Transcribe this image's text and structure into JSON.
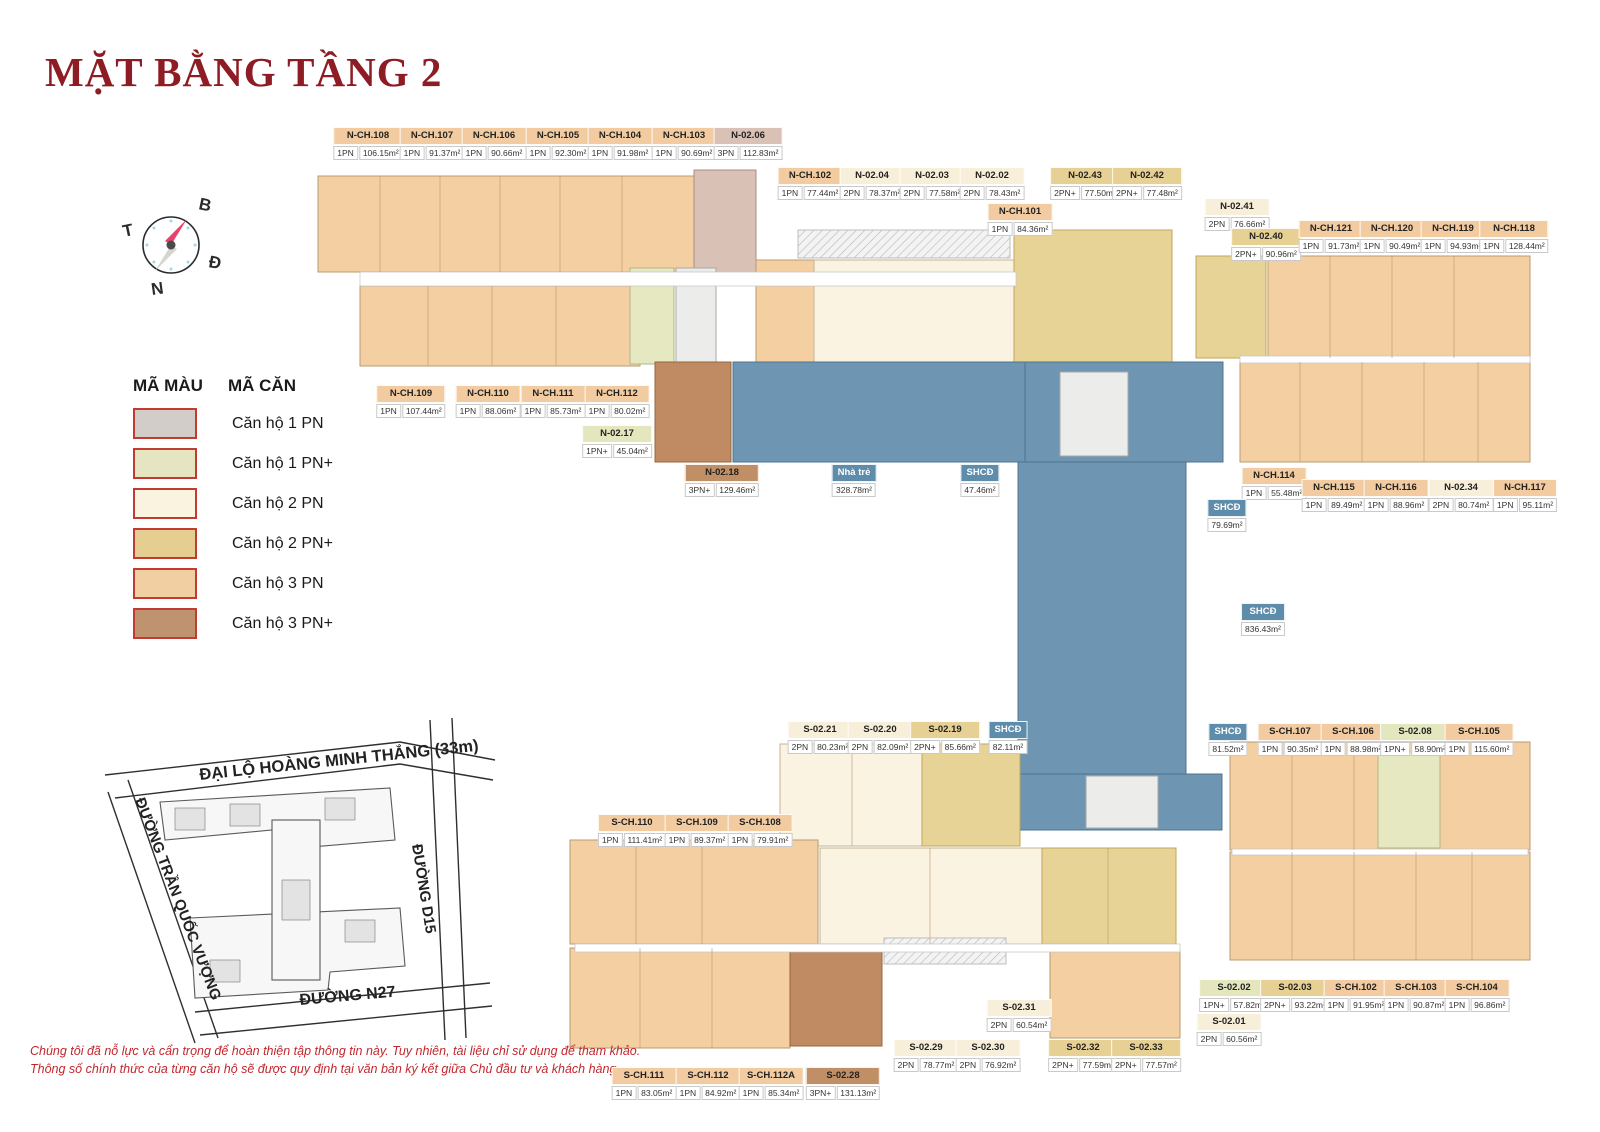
{
  "title": "MẶT BẰNG TẦNG 2",
  "compass": {
    "north": "B",
    "east": "Đ",
    "south": "N",
    "west": "T"
  },
  "legend": {
    "col1_header": "MÃ MÀU",
    "col2_header": "MÃ CĂN",
    "items": [
      {
        "type": "1PN",
        "label": "Căn hộ 1 PN",
        "color": "#d3cdc9"
      },
      {
        "type": "1PN+",
        "label": "Căn hộ 1 PN+",
        "color": "#e5e5c2"
      },
      {
        "type": "2PN",
        "label": "Căn hộ 2 PN",
        "color": "#faf3e0"
      },
      {
        "type": "2PN+",
        "label": "Căn hộ 2 PN+",
        "color": "#e5cf90"
      },
      {
        "type": "3PN",
        "label": "Căn hộ 3 PN",
        "color": "#f2cfa3"
      },
      {
        "type": "3PN+",
        "label": "Căn hộ 3 PN+",
        "color": "#bf9270"
      }
    ],
    "swatch_border_color": "#c13b33"
  },
  "site_map": {
    "streets": [
      "ĐẠI LỘ HOÀNG MINH THẮNG (33m)",
      "ĐƯỜNG TRẦN QUỐC VƯỢNG",
      "ĐƯỜNG D15",
      "ĐƯỜNG N27"
    ]
  },
  "disclaimer": {
    "line1": "Chúng tôi đã nỗ lực và cẩn trọng để hoàn thiện tập thông tin này. Tuy nhiên, tài liệu chỉ sử dụng để tham khảo.",
    "line2": "Thông số chính thức của từng căn hộ sẽ được quy định tại văn bản ký kết giữa Chủ đầu tư và khách hàng."
  },
  "shcd_color": "#6e95b1",
  "units": [
    {
      "code": "N-CH.108",
      "beds": "1PN",
      "area": "106.15m²",
      "x": 368,
      "y": 127,
      "hdr": "orange"
    },
    {
      "code": "N-CH.107",
      "beds": "1PN",
      "area": "91.37m²",
      "x": 432,
      "y": 127,
      "hdr": "orange"
    },
    {
      "code": "N-CH.106",
      "beds": "1PN",
      "area": "90.66m²",
      "x": 494,
      "y": 127,
      "hdr": "orange"
    },
    {
      "code": "N-CH.105",
      "beds": "1PN",
      "area": "92.30m²",
      "x": 558,
      "y": 127,
      "hdr": "orange"
    },
    {
      "code": "N-CH.104",
      "beds": "1PN",
      "area": "91.98m²",
      "x": 620,
      "y": 127,
      "hdr": "orange"
    },
    {
      "code": "N-CH.103",
      "beds": "1PN",
      "area": "90.69m²",
      "x": 684,
      "y": 127,
      "hdr": "orange"
    },
    {
      "code": "N-02.06",
      "beds": "3PN",
      "area": "112.83m²",
      "x": 748,
      "y": 127,
      "hdr": "pink"
    },
    {
      "code": "N-CH.102",
      "beds": "1PN",
      "area": "77.44m²",
      "x": 810,
      "y": 167,
      "hdr": "orange"
    },
    {
      "code": "N-02.04",
      "beds": "2PN",
      "area": "78.37m²",
      "x": 872,
      "y": 167,
      "hdr": "cream"
    },
    {
      "code": "N-02.03",
      "beds": "2PN",
      "area": "77.58m²",
      "x": 932,
      "y": 167,
      "hdr": "cream"
    },
    {
      "code": "N-02.02",
      "beds": "2PN",
      "area": "78.43m²",
      "x": 992,
      "y": 167,
      "hdr": "cream"
    },
    {
      "code": "N-02.43",
      "beds": "2PN+",
      "area": "77.50m²",
      "x": 1085,
      "y": 167,
      "hdr": "tan"
    },
    {
      "code": "N-02.42",
      "beds": "2PN+",
      "area": "77.48m²",
      "x": 1147,
      "y": 167,
      "hdr": "tan"
    },
    {
      "code": "N-CH.101",
      "beds": "1PN",
      "area": "84.36m²",
      "x": 1020,
      "y": 203,
      "hdr": "orange"
    },
    {
      "code": "N-02.41",
      "beds": "2PN",
      "area": "76.66m²",
      "x": 1237,
      "y": 198,
      "hdr": "cream"
    },
    {
      "code": "N-02.40",
      "beds": "2PN+",
      "area": "90.96m²",
      "x": 1266,
      "y": 228,
      "hdr": "tan"
    },
    {
      "code": "N-CH.121",
      "beds": "1PN",
      "area": "91.73m²",
      "x": 1331,
      "y": 220,
      "hdr": "orange"
    },
    {
      "code": "N-CH.120",
      "beds": "1PN",
      "area": "90.49m²",
      "x": 1392,
      "y": 220,
      "hdr": "orange"
    },
    {
      "code": "N-CH.119",
      "beds": "1PN",
      "area": "94.93m²",
      "x": 1453,
      "y": 220,
      "hdr": "orange"
    },
    {
      "code": "N-CH.118",
      "beds": "1PN",
      "area": "128.44m²",
      "x": 1514,
      "y": 220,
      "hdr": "orange"
    },
    {
      "code": "N-CH.109",
      "beds": "1PN",
      "area": "107.44m²",
      "x": 411,
      "y": 385,
      "hdr": "orange"
    },
    {
      "code": "N-CH.110",
      "beds": "1PN",
      "area": "88.06m²",
      "x": 488,
      "y": 385,
      "hdr": "orange"
    },
    {
      "code": "N-CH.111",
      "beds": "1PN",
      "area": "85.73m²",
      "x": 553,
      "y": 385,
      "hdr": "orange"
    },
    {
      "code": "N-CH.112",
      "beds": "1PN",
      "area": "80.02m²",
      "x": 617,
      "y": 385,
      "hdr": "orange"
    },
    {
      "code": "N-02.17",
      "beds": "1PN+",
      "area": "45.04m²",
      "x": 617,
      "y": 425,
      "hdr": "green"
    },
    {
      "code": "N-02.18",
      "beds": "3PN+",
      "area": "129.46m²",
      "x": 722,
      "y": 464,
      "hdr": "brown"
    },
    {
      "code": "Nhà trẻ",
      "beds": null,
      "area": "328.78m²",
      "x": 854,
      "y": 464,
      "hdr": "blue"
    },
    {
      "code": "SHCĐ",
      "beds": null,
      "area": "47.46m²",
      "x": 980,
      "y": 464,
      "hdr": "blue"
    },
    {
      "code": "N-CH.114",
      "beds": "1PN",
      "area": "55.48m²",
      "x": 1274,
      "y": 467,
      "hdr": "orange"
    },
    {
      "code": "N-CH.115",
      "beds": "1PN",
      "area": "89.49m²",
      "x": 1334,
      "y": 479,
      "hdr": "orange"
    },
    {
      "code": "N-CH.116",
      "beds": "1PN",
      "area": "88.96m²",
      "x": 1396,
      "y": 479,
      "hdr": "orange"
    },
    {
      "code": "N-02.34",
      "beds": "2PN",
      "area": "80.74m²",
      "x": 1461,
      "y": 479,
      "hdr": "cream"
    },
    {
      "code": "N-CH.117",
      "beds": "1PN",
      "area": "95.11m²",
      "x": 1525,
      "y": 479,
      "hdr": "orange"
    },
    {
      "code": "SHCĐ",
      "beds": null,
      "area": "79.69m²",
      "x": 1227,
      "y": 499,
      "hdr": "blue"
    },
    {
      "code": "SHCĐ",
      "beds": null,
      "area": "836.43m²",
      "x": 1263,
      "y": 603,
      "hdr": "blue"
    },
    {
      "code": "S-02.21",
      "beds": "2PN",
      "area": "80.23m²",
      "x": 820,
      "y": 721,
      "hdr": "cream"
    },
    {
      "code": "S-02.20",
      "beds": "2PN",
      "area": "82.09m²",
      "x": 880,
      "y": 721,
      "hdr": "cream"
    },
    {
      "code": "S-02.19",
      "beds": "2PN+",
      "area": "85.66m²",
      "x": 945,
      "y": 721,
      "hdr": "tan"
    },
    {
      "code": "SHCĐ",
      "beds": null,
      "area": "82.11m²",
      "x": 1008,
      "y": 721,
      "hdr": "blue"
    },
    {
      "code": "SHCĐ",
      "beds": null,
      "area": "81.52m²",
      "x": 1228,
      "y": 723,
      "hdr": "blue"
    },
    {
      "code": "S-CH.107",
      "beds": "1PN",
      "area": "90.35m²",
      "x": 1290,
      "y": 723,
      "hdr": "orange"
    },
    {
      "code": "S-CH.106",
      "beds": "1PN",
      "area": "88.98m²",
      "x": 1353,
      "y": 723,
      "hdr": "orange"
    },
    {
      "code": "S-02.08",
      "beds": "1PN+",
      "area": "58.90m²",
      "x": 1415,
      "y": 723,
      "hdr": "green"
    },
    {
      "code": "S-CH.105",
      "beds": "1PN",
      "area": "115.60m²",
      "x": 1479,
      "y": 723,
      "hdr": "orange"
    },
    {
      "code": "S-CH.110",
      "beds": "1PN",
      "area": "111.41m²",
      "x": 632,
      "y": 814,
      "hdr": "orange"
    },
    {
      "code": "S-CH.109",
      "beds": "1PN",
      "area": "89.37m²",
      "x": 697,
      "y": 814,
      "hdr": "orange"
    },
    {
      "code": "S-CH.108",
      "beds": "1PN",
      "area": "79.91m²",
      "x": 760,
      "y": 814,
      "hdr": "orange"
    },
    {
      "code": "S-02.02",
      "beds": "1PN+",
      "area": "57.82m²",
      "x": 1234,
      "y": 979,
      "hdr": "green"
    },
    {
      "code": "S-02.03",
      "beds": "2PN+",
      "area": "93.22m²",
      "x": 1295,
      "y": 979,
      "hdr": "tan"
    },
    {
      "code": "S-CH.102",
      "beds": "1PN",
      "area": "91.95m²",
      "x": 1356,
      "y": 979,
      "hdr": "orange"
    },
    {
      "code": "S-CH.103",
      "beds": "1PN",
      "area": "90.87m²",
      "x": 1416,
      "y": 979,
      "hdr": "orange"
    },
    {
      "code": "S-CH.104",
      "beds": "1PN",
      "area": "96.86m²",
      "x": 1477,
      "y": 979,
      "hdr": "orange"
    },
    {
      "code": "S-02.31",
      "beds": "2PN",
      "area": "60.54m²",
      "x": 1019,
      "y": 999,
      "hdr": "cream"
    },
    {
      "code": "S-02.01",
      "beds": "2PN",
      "area": "60.56m²",
      "x": 1229,
      "y": 1013,
      "hdr": "cream"
    },
    {
      "code": "S-02.29",
      "beds": "2PN",
      "area": "78.77m²",
      "x": 926,
      "y": 1039,
      "hdr": "cream"
    },
    {
      "code": "S-02.30",
      "beds": "2PN",
      "area": "76.92m²",
      "x": 988,
      "y": 1039,
      "hdr": "cream"
    },
    {
      "code": "S-02.32",
      "beds": "2PN+",
      "area": "77.59m²",
      "x": 1083,
      "y": 1039,
      "hdr": "tan"
    },
    {
      "code": "S-02.33",
      "beds": "2PN+",
      "area": "77.57m²",
      "x": 1146,
      "y": 1039,
      "hdr": "tan"
    },
    {
      "code": "S-CH.111",
      "beds": "1PN",
      "area": "83.05m²",
      "x": 644,
      "y": 1067,
      "hdr": "orange"
    },
    {
      "code": "S-CH.112",
      "beds": "1PN",
      "area": "84.92m²",
      "x": 708,
      "y": 1067,
      "hdr": "orange"
    },
    {
      "code": "S-CH.112A",
      "beds": "1PN",
      "area": "85.34m²",
      "x": 771,
      "y": 1067,
      "hdr": "orange"
    },
    {
      "code": "S-02.28",
      "beds": "3PN+",
      "area": "131.13m²",
      "x": 843,
      "y": 1067,
      "hdr": "brown"
    }
  ]
}
